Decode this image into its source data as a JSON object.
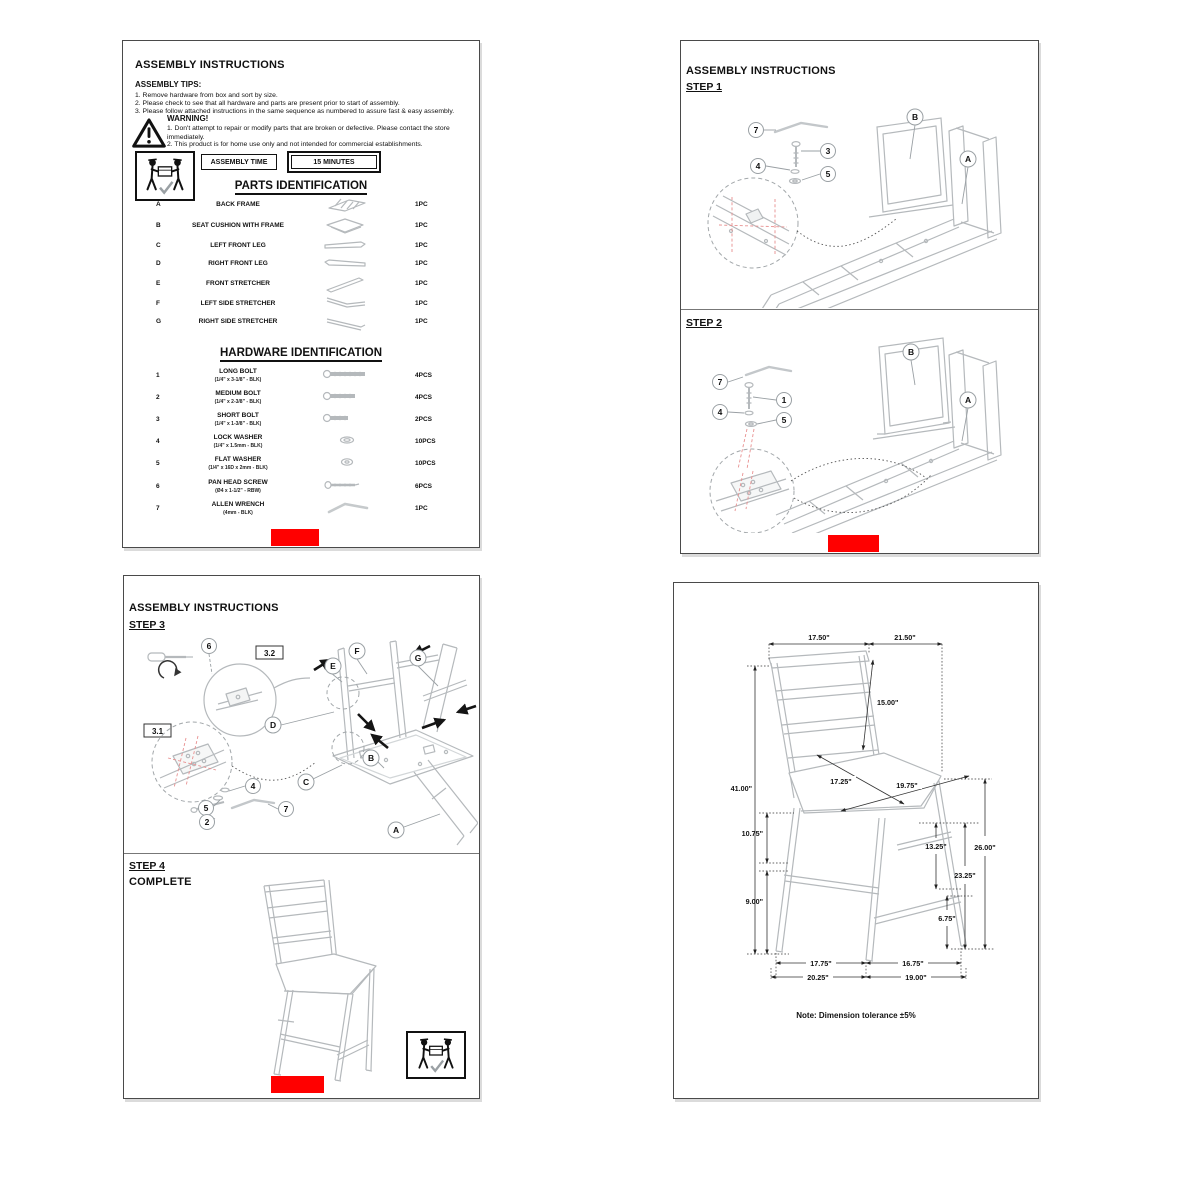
{
  "colors": {
    "accent_red": "#FF0000",
    "drawing_gray": "#b5b9bc",
    "detail_red_dash": "#e89090",
    "text": "#111111"
  },
  "page1": {
    "title": "ASSEMBLY INSTRUCTIONS",
    "tips_heading": "ASSEMBLY TIPS:",
    "tips": [
      "1. Remove hardware from box and sort by size.",
      "2. Please check to see that all hardware and parts are present prior to start of assembly.",
      "3. Please follow attached instructions in the same sequence as numbered to assure fast & easy assembly."
    ],
    "warning_heading": "WARNING!",
    "warnings": [
      "1. Don't attempt to repair or modify parts that are broken or defective.  Please contact the store immediately.",
      "2. This product is for home use only and not intended for commercial establishments."
    ],
    "assembly_time_label": "ASSEMBLY TIME",
    "assembly_time_value": "15 MINUTES",
    "parts_heading": "PARTS IDENTIFICATION",
    "parts": [
      {
        "id": "A",
        "name": "BACK FRAME",
        "qty": "1PC"
      },
      {
        "id": "B",
        "name": "SEAT CUSHION WITH FRAME",
        "qty": "1PC"
      },
      {
        "id": "C",
        "name": "LEFT FRONT LEG",
        "qty": "1PC"
      },
      {
        "id": "D",
        "name": "RIGHT FRONT LEG",
        "qty": "1PC"
      },
      {
        "id": "E",
        "name": "FRONT STRETCHER",
        "qty": "1PC"
      },
      {
        "id": "F",
        "name": "LEFT SIDE STRETCHER",
        "qty": "1PC"
      },
      {
        "id": "G",
        "name": "RIGHT SIDE STRETCHER",
        "qty": "1PC"
      }
    ],
    "hardware_heading": "HARDWARE IDENTIFICATION",
    "hardware": [
      {
        "id": "1",
        "name": "LONG BOLT",
        "spec": "(1/4\" x 3-1/8\" - BLK)",
        "qty": "4PCS"
      },
      {
        "id": "2",
        "name": "MEDIUM BOLT",
        "spec": "(1/4\" x 2-3/8\" - BLK)",
        "qty": "4PCS"
      },
      {
        "id": "3",
        "name": "SHORT BOLT",
        "spec": "(1/4\" x 1-3/8\" - BLK)",
        "qty": "2PCS"
      },
      {
        "id": "4",
        "name": "LOCK WASHER",
        "spec": "(1/4\" x 1.5mm - BLK)",
        "qty": "10PCS"
      },
      {
        "id": "5",
        "name": "FLAT WASHER",
        "spec": "(1/4\" x 16D x 2mm - BLK)",
        "qty": "10PCS"
      },
      {
        "id": "6",
        "name": "PAN HEAD SCREW",
        "spec": "(Ø4 x 1-1/2\" - RBW)",
        "qty": "6PCS"
      },
      {
        "id": "7",
        "name": "ALLEN WRENCH",
        "spec": "(4mm - BLK)",
        "qty": "1PC"
      }
    ]
  },
  "page2": {
    "title": "ASSEMBLY INSTRUCTIONS",
    "step1": {
      "label": "STEP 1",
      "callouts": [
        "7",
        "3",
        "4",
        "5",
        "B",
        "A"
      ]
    },
    "step2": {
      "label": "STEP 2",
      "callouts": [
        "7",
        "1",
        "4",
        "5",
        "B",
        "A"
      ]
    }
  },
  "page3": {
    "title": "ASSEMBLY INSTRUCTIONS",
    "step3": {
      "label": "STEP 3",
      "detail_boxes": [
        "3.2",
        "3.1"
      ],
      "callouts": [
        "6",
        "E",
        "F",
        "G",
        "D",
        "C",
        "B",
        "4",
        "5",
        "2",
        "7",
        "A"
      ]
    },
    "step4": {
      "label": "STEP 4",
      "status": "COMPLETE"
    }
  },
  "page4": {
    "dims": [
      "17.50\"",
      "21.50\"",
      "15.00\"",
      "41.00\"",
      "17.25\"",
      "19.75\"",
      "10.75\"",
      "13.25\"",
      "26.00\"",
      "23.25\"",
      "9.00\"",
      "6.75\"",
      "17.75\"",
      "16.75\"",
      "20.25\"",
      "19.00\""
    ],
    "note": "Note: Dimension tolerance ±5%"
  }
}
